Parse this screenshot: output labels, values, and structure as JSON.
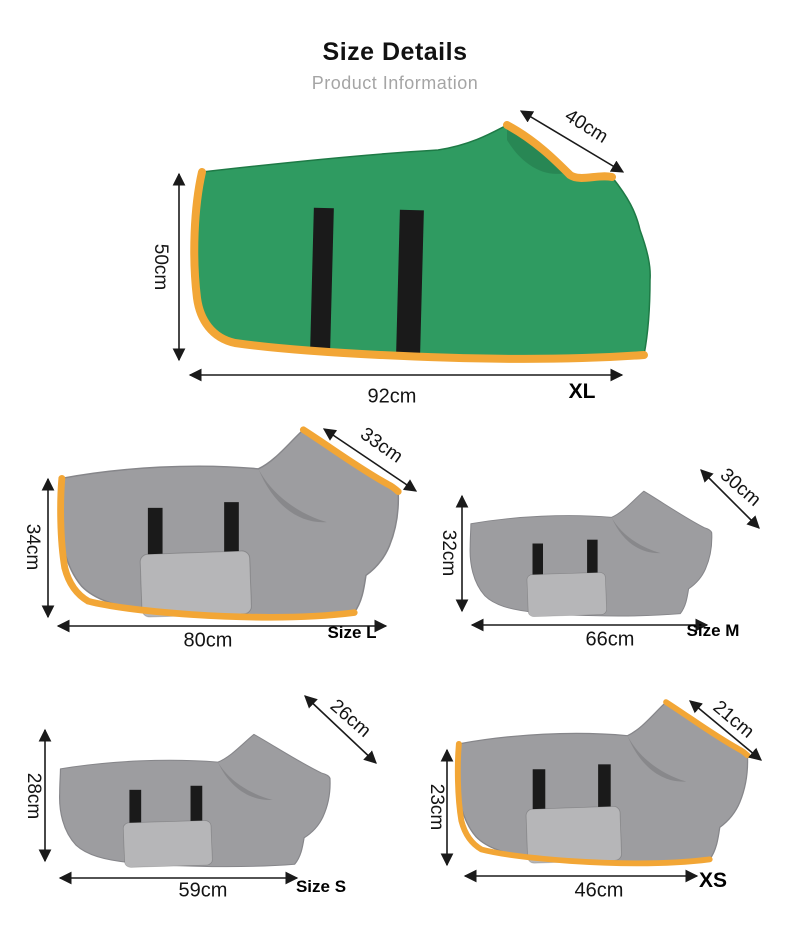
{
  "header": {
    "title": "Size Details",
    "subtitle": "Product Information"
  },
  "figures": [
    {
      "size_label": "XL",
      "neck_width": "40cm",
      "back_height": "50cm",
      "back_length": "92cm",
      "robe_color": "green"
    },
    {
      "size_label": "Size L",
      "neck_width": "33cm",
      "back_height": "34cm",
      "back_length": "80cm",
      "robe_color": "gray-orange-trim"
    },
    {
      "size_label": "Size M",
      "neck_width": "30cm",
      "back_height": "32cm",
      "back_length": "66cm",
      "robe_color": "gray"
    },
    {
      "size_label": "Size S",
      "neck_width": "26cm",
      "back_height": "28cm",
      "back_length": "59cm",
      "robe_color": "gray"
    },
    {
      "size_label": "XS",
      "neck_width": "21cm",
      "back_height": "23cm",
      "back_length": "46cm",
      "robe_color": "gray-orange-trim"
    }
  ],
  "colors": {
    "robe_green": "#2f9b61",
    "trim_orange": "#f2a636",
    "robe_gray": "#9d9da0",
    "robe_gray_light": "#b6b6b8",
    "strap_black": "#1a1a1a"
  }
}
